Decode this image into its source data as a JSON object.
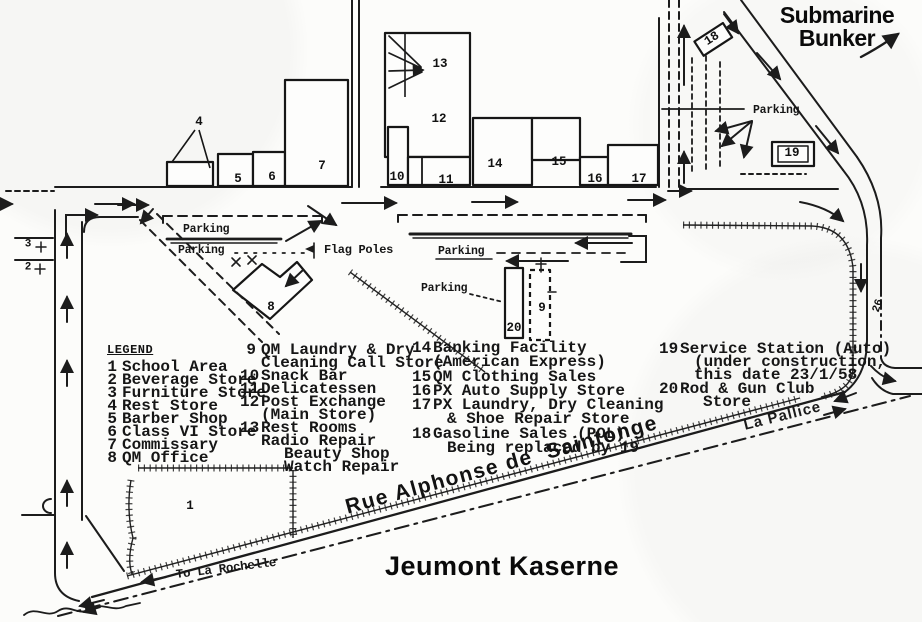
{
  "title": "Jeumont Kaserne",
  "landmarks": {
    "submarine_bunker": [
      "Submarine",
      "Bunker"
    ],
    "street_name": "Rue Alphonse de  Saintonge",
    "la_pallice": "La Pallice",
    "to_la_rochelle": "To La Rochelle",
    "flag_poles": "Flag Poles",
    "parking": "Parking",
    "road_number": "26"
  },
  "legend": {
    "heading": "LEGEND",
    "columns": [
      {
        "items": [
          {
            "num": "1",
            "lines": [
              "School Area"
            ]
          },
          {
            "num": "2",
            "lines": [
              "Beverage Store"
            ]
          },
          {
            "num": "3",
            "lines": [
              "Furniture Store"
            ]
          },
          {
            "num": "4",
            "lines": [
              "Rest Store"
            ]
          },
          {
            "num": "5",
            "lines": [
              "Barber Shop"
            ]
          },
          {
            "num": "6",
            "lines": [
              "Class VI Store"
            ]
          },
          {
            "num": "7",
            "lines": [
              "Commissary"
            ]
          },
          {
            "num": "8",
            "lines": [
              "QM Office"
            ]
          }
        ]
      },
      {
        "items": [
          {
            "num": "9",
            "lines": [
              "QM Laundry & Dry",
              "Cleaning Call Store"
            ]
          },
          {
            "num": "10",
            "lines": [
              "Snack Bar"
            ]
          },
          {
            "num": "11",
            "lines": [
              "Delicatessen"
            ]
          },
          {
            "num": "12",
            "lines": [
              "Post Exchange",
              "(Main Store)"
            ]
          },
          {
            "num": "13",
            "lines": [
              "Rest Rooms",
              "Radio Repair",
              "Beauty Shop",
              "Watch Repair"
            ]
          }
        ]
      },
      {
        "items": [
          {
            "num": "14",
            "lines": [
              "Banking Facility",
              "(American Express)"
            ]
          },
          {
            "num": "15",
            "lines": [
              "QM Clothing Sales"
            ]
          },
          {
            "num": "16",
            "lines": [
              "PX Auto Supply Store"
            ]
          },
          {
            "num": "17",
            "lines": [
              "PX Laundry, Dry Cleaning",
              "& Shoe Repair Store"
            ]
          },
          {
            "num": "18",
            "lines": [
              "Gasoline Sales (POL)",
              "Being replaced by 19"
            ]
          }
        ]
      },
      {
        "items": [
          {
            "num": "19",
            "lines": [
              "Service Station (Auto)",
              "(under construction,",
              "this date 23/1/58"
            ]
          },
          {
            "num": "20",
            "lines": [
              "Rod & Gun Club",
              "Store"
            ]
          }
        ]
      }
    ]
  },
  "map_numbers": {
    "n1": "1",
    "n2": "2",
    "n3": "3",
    "n4": "4",
    "n5": "5",
    "n6": "6",
    "n7": "7",
    "n8": "8",
    "n9": "9",
    "n10": "10",
    "n11": "11",
    "n12": "12",
    "n13": "13",
    "n14": "14",
    "n15": "15",
    "n16": "16",
    "n17": "17",
    "n18": "18",
    "n19": "19",
    "n20": "20",
    "n26": "26"
  }
}
